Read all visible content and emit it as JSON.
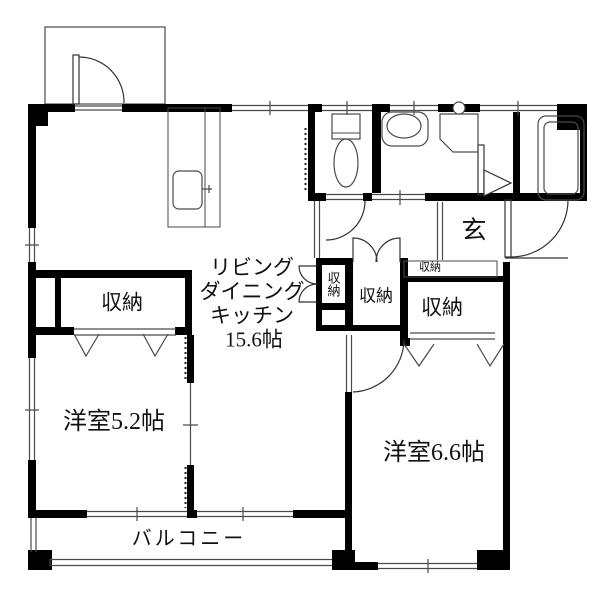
{
  "labels": {
    "ldk_line1": "リビング",
    "ldk_line2": "ダイニング",
    "ldk_line3": "キッチン",
    "ldk_line4": "15.6帖",
    "room_5_2": "洋室5.2帖",
    "room_6_6": "洋室6.6帖",
    "closet_5_2": "収納",
    "closet_narrow": "収納",
    "closet_hall": "収納",
    "closet_6_6_small": "収納",
    "closet_6_6": "収納",
    "entrance": "玄",
    "balcony": "バルコニー"
  },
  "colors": {
    "wall": "#000000",
    "line": "#4a4a4a",
    "background": "#ffffff"
  }
}
